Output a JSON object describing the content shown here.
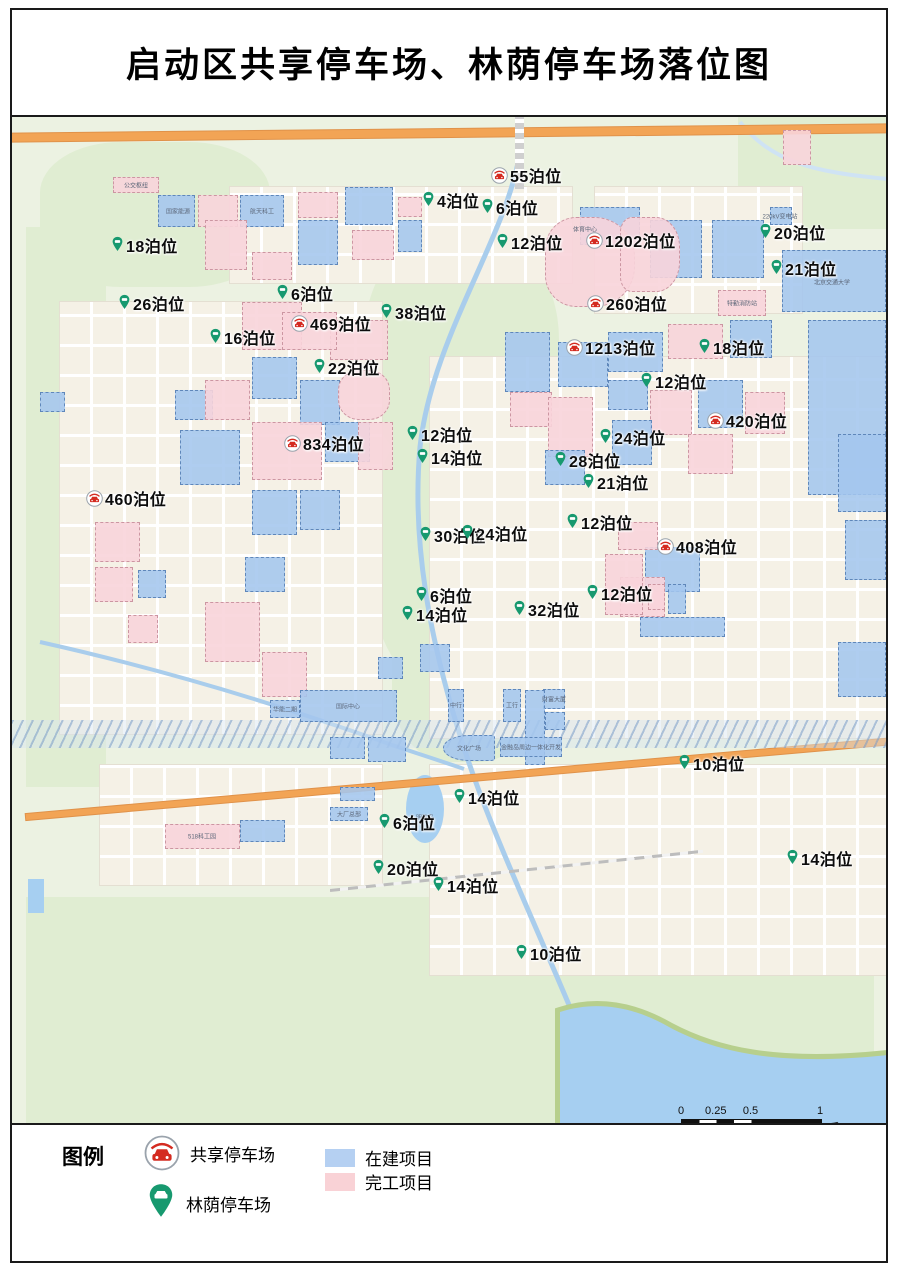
{
  "title": "启动区共享停车场、林荫停车场落位图",
  "legend": {
    "heading": "图例",
    "shared_label": "共享停车场",
    "shade_label": "林荫停车场",
    "construction_label": "在建项目",
    "completed_label": "完工项目",
    "colors": {
      "construction_fill": "#a4c6ee",
      "completed_fill": "#f8d4da",
      "shared_icon_red": "#d42b20",
      "shade_icon_green": "#17996f"
    }
  },
  "scalebar": {
    "ticks": [
      "0",
      "0.25",
      "0.5",
      "1"
    ],
    "unit": "千米"
  },
  "map": {
    "markers": [
      {
        "type": "shared",
        "label": "55泊位",
        "x": 485,
        "y": 60
      },
      {
        "type": "shared",
        "label": "1202泊位",
        "x": 580,
        "y": 125
      },
      {
        "type": "shared",
        "label": "469泊位",
        "x": 285,
        "y": 208
      },
      {
        "type": "shared",
        "label": "260泊位",
        "x": 581,
        "y": 188
      },
      {
        "type": "shared",
        "label": "1213泊位",
        "x": 560,
        "y": 232
      },
      {
        "type": "shared",
        "label": "834泊位",
        "x": 278,
        "y": 328
      },
      {
        "type": "shared",
        "label": "460泊位",
        "x": 80,
        "y": 383
      },
      {
        "type": "shared",
        "label": "420泊位",
        "x": 701,
        "y": 305
      },
      {
        "type": "shared",
        "label": "408泊位",
        "x": 651,
        "y": 431
      },
      {
        "type": "shade",
        "label": "4泊位",
        "x": 416,
        "y": 85
      },
      {
        "type": "shade",
        "label": "6泊位",
        "x": 475,
        "y": 92
      },
      {
        "type": "shade",
        "label": "12泊位",
        "x": 490,
        "y": 127
      },
      {
        "type": "shade",
        "label": "18泊位",
        "x": 105,
        "y": 130
      },
      {
        "type": "shade",
        "label": "20泊位",
        "x": 753,
        "y": 117
      },
      {
        "type": "shade",
        "label": "21泊位",
        "x": 764,
        "y": 153
      },
      {
        "type": "shade",
        "label": "26泊位",
        "x": 112,
        "y": 188
      },
      {
        "type": "shade",
        "label": "6泊位",
        "x": 270,
        "y": 178
      },
      {
        "type": "shade",
        "label": "16泊位",
        "x": 203,
        "y": 222
      },
      {
        "type": "shade",
        "label": "38泊位",
        "x": 374,
        "y": 197
      },
      {
        "type": "shade",
        "label": "22泊位",
        "x": 307,
        "y": 252
      },
      {
        "type": "shade",
        "label": "18泊位",
        "x": 692,
        "y": 232
      },
      {
        "type": "shade",
        "label": "12泊位",
        "x": 634,
        "y": 266
      },
      {
        "type": "shade",
        "label": "12泊位",
        "x": 400,
        "y": 319
      },
      {
        "type": "shade",
        "label": "14泊位",
        "x": 410,
        "y": 342
      },
      {
        "type": "shade",
        "label": "24泊位",
        "x": 593,
        "y": 322
      },
      {
        "type": "shade",
        "label": "28泊位",
        "x": 548,
        "y": 345
      },
      {
        "type": "shade",
        "label": "21泊位",
        "x": 576,
        "y": 367
      },
      {
        "type": "shade",
        "label": "12泊位",
        "x": 560,
        "y": 407
      },
      {
        "type": "shade",
        "label": "30泊位",
        "x": 413,
        "y": 420
      },
      {
        "type": "shade",
        "label": "24泊位",
        "x": 455,
        "y": 418
      },
      {
        "type": "shade",
        "label": "6泊位",
        "x": 409,
        "y": 480
      },
      {
        "type": "shade",
        "label": "14泊位",
        "x": 395,
        "y": 499
      },
      {
        "type": "shade",
        "label": "32泊位",
        "x": 507,
        "y": 494
      },
      {
        "type": "shade",
        "label": "12泊位",
        "x": 580,
        "y": 478
      },
      {
        "type": "shade",
        "label": "10泊位",
        "x": 672,
        "y": 648
      },
      {
        "type": "shade",
        "label": "14泊位",
        "x": 447,
        "y": 682
      },
      {
        "type": "shade",
        "label": "6泊位",
        "x": 372,
        "y": 707
      },
      {
        "type": "shade",
        "label": "20泊位",
        "x": 366,
        "y": 753
      },
      {
        "type": "shade",
        "label": "14泊位",
        "x": 426,
        "y": 770
      },
      {
        "type": "shade",
        "label": "10泊位",
        "x": 509,
        "y": 838
      },
      {
        "type": "shade",
        "label": "14泊位",
        "x": 780,
        "y": 743
      }
    ],
    "labels": [
      {
        "t": "体育中心",
        "x": 573,
        "y": 112
      },
      {
        "t": "北京交通大学",
        "x": 820,
        "y": 165
      },
      {
        "t": "220kV变电站",
        "x": 768,
        "y": 99
      },
      {
        "t": "特勤消防站",
        "x": 730,
        "y": 186
      },
      {
        "t": "公交枢纽",
        "x": 124,
        "y": 68
      },
      {
        "t": "国家能源",
        "x": 166,
        "y": 94
      },
      {
        "t": "航天科工",
        "x": 250,
        "y": 94
      },
      {
        "t": "文化广场",
        "x": 457,
        "y": 631
      },
      {
        "t": "金融岛周边一体化开发",
        "x": 519,
        "y": 630
      },
      {
        "t": "明珠岛",
        "x": 413,
        "y": 700
      },
      {
        "t": "大厂总部",
        "x": 337,
        "y": 697
      },
      {
        "t": "518科工园",
        "x": 190,
        "y": 719
      },
      {
        "t": "国际中心",
        "x": 336,
        "y": 589
      },
      {
        "t": "华能二期",
        "x": 273,
        "y": 592
      },
      {
        "t": "财富大厦",
        "x": 542,
        "y": 582
      },
      {
        "t": "中行",
        "x": 444,
        "y": 588
      },
      {
        "t": "工行",
        "x": 500,
        "y": 588
      }
    ],
    "shapes": [
      {
        "t": "b",
        "x": 146,
        "y": 78,
        "w": 37,
        "h": 32
      },
      {
        "t": "p",
        "x": 186,
        "y": 78,
        "w": 40,
        "h": 32
      },
      {
        "t": "b",
        "x": 228,
        "y": 78,
        "w": 44,
        "h": 32
      },
      {
        "t": "p",
        "x": 101,
        "y": 60,
        "w": 46,
        "h": 16
      },
      {
        "t": "p",
        "x": 193,
        "y": 103,
        "w": 42,
        "h": 50
      },
      {
        "t": "p",
        "x": 240,
        "y": 135,
        "w": 40,
        "h": 28
      },
      {
        "t": "b",
        "x": 286,
        "y": 103,
        "w": 40,
        "h": 45
      },
      {
        "t": "p",
        "x": 286,
        "y": 75,
        "w": 40,
        "h": 26
      },
      {
        "t": "b",
        "x": 333,
        "y": 70,
        "w": 48,
        "h": 38
      },
      {
        "t": "p",
        "x": 340,
        "y": 113,
        "w": 42,
        "h": 30
      },
      {
        "t": "b",
        "x": 386,
        "y": 103,
        "w": 24,
        "h": 32
      },
      {
        "t": "p",
        "x": 386,
        "y": 80,
        "w": 24,
        "h": 20
      },
      {
        "t": "b",
        "x": 568,
        "y": 90,
        "w": 60,
        "h": 38
      },
      {
        "t": "b",
        "x": 638,
        "y": 103,
        "w": 52,
        "h": 58
      },
      {
        "t": "b",
        "x": 700,
        "y": 103,
        "w": 52,
        "h": 58
      },
      {
        "t": "p",
        "x": 533,
        "y": 100,
        "w": 90,
        "h": 90,
        "br": "35% 45% 45% 35%"
      },
      {
        "t": "p",
        "x": 608,
        "y": 100,
        "w": 60,
        "h": 75,
        "br": "20% 40% 40% 20%"
      },
      {
        "t": "b",
        "x": 770,
        "y": 133,
        "w": 104,
        "h": 62
      },
      {
        "t": "b",
        "x": 758,
        "y": 90,
        "w": 22,
        "h": 18
      },
      {
        "t": "p",
        "x": 771,
        "y": 13,
        "w": 28,
        "h": 35
      },
      {
        "t": "b",
        "x": 796,
        "y": 203,
        "w": 78,
        "h": 175
      },
      {
        "t": "p",
        "x": 706,
        "y": 173,
        "w": 48,
        "h": 26
      },
      {
        "t": "p",
        "x": 230,
        "y": 185,
        "w": 60,
        "h": 48
      },
      {
        "t": "b",
        "x": 163,
        "y": 273,
        "w": 38,
        "h": 30
      },
      {
        "t": "p",
        "x": 193,
        "y": 263,
        "w": 45,
        "h": 40
      },
      {
        "t": "b",
        "x": 240,
        "y": 240,
        "w": 45,
        "h": 42
      },
      {
        "t": "b",
        "x": 288,
        "y": 263,
        "w": 40,
        "h": 45
      },
      {
        "t": "p",
        "x": 318,
        "y": 203,
        "w": 58,
        "h": 40
      },
      {
        "t": "p",
        "x": 270,
        "y": 195,
        "w": 55,
        "h": 38
      },
      {
        "t": "p",
        "x": 326,
        "y": 253,
        "w": 52,
        "h": 50,
        "br": "40%"
      },
      {
        "t": "b",
        "x": 168,
        "y": 313,
        "w": 60,
        "h": 55
      },
      {
        "t": "p",
        "x": 240,
        "y": 305,
        "w": 70,
        "h": 58
      },
      {
        "t": "b",
        "x": 313,
        "y": 305,
        "w": 45,
        "h": 40
      },
      {
        "t": "p",
        "x": 346,
        "y": 305,
        "w": 35,
        "h": 48
      },
      {
        "t": "b",
        "x": 240,
        "y": 373,
        "w": 45,
        "h": 45
      },
      {
        "t": "b",
        "x": 288,
        "y": 373,
        "w": 40,
        "h": 40
      },
      {
        "t": "p",
        "x": 193,
        "y": 485,
        "w": 55,
        "h": 60
      },
      {
        "t": "p",
        "x": 250,
        "y": 535,
        "w": 45,
        "h": 45
      },
      {
        "t": "b",
        "x": 233,
        "y": 440,
        "w": 40,
        "h": 35
      },
      {
        "t": "b",
        "x": 126,
        "y": 453,
        "w": 28,
        "h": 28
      },
      {
        "t": "p",
        "x": 116,
        "y": 498,
        "w": 30,
        "h": 28
      },
      {
        "t": "p",
        "x": 83,
        "y": 405,
        "w": 45,
        "h": 40
      },
      {
        "t": "p",
        "x": 83,
        "y": 450,
        "w": 38,
        "h": 35
      },
      {
        "t": "b",
        "x": 28,
        "y": 275,
        "w": 25,
        "h": 20
      },
      {
        "t": "b",
        "x": 493,
        "y": 215,
        "w": 45,
        "h": 60
      },
      {
        "t": "b",
        "x": 546,
        "y": 225,
        "w": 50,
        "h": 45
      },
      {
        "t": "p",
        "x": 498,
        "y": 275,
        "w": 42,
        "h": 35
      },
      {
        "t": "p",
        "x": 536,
        "y": 280,
        "w": 45,
        "h": 60
      },
      {
        "t": "b",
        "x": 596,
        "y": 215,
        "w": 55,
        "h": 40
      },
      {
        "t": "p",
        "x": 656,
        "y": 207,
        "w": 55,
        "h": 35
      },
      {
        "t": "b",
        "x": 718,
        "y": 203,
        "w": 42,
        "h": 38
      },
      {
        "t": "b",
        "x": 596,
        "y": 263,
        "w": 40,
        "h": 30
      },
      {
        "t": "p",
        "x": 638,
        "y": 273,
        "w": 42,
        "h": 45
      },
      {
        "t": "b",
        "x": 686,
        "y": 263,
        "w": 45,
        "h": 48
      },
      {
        "t": "p",
        "x": 733,
        "y": 275,
        "w": 40,
        "h": 42
      },
      {
        "t": "b",
        "x": 600,
        "y": 303,
        "w": 40,
        "h": 45
      },
      {
        "t": "p",
        "x": 676,
        "y": 317,
        "w": 45,
        "h": 40
      },
      {
        "t": "b",
        "x": 533,
        "y": 333,
        "w": 40,
        "h": 35
      },
      {
        "t": "b",
        "x": 633,
        "y": 430,
        "w": 55,
        "h": 45
      },
      {
        "t": "p",
        "x": 608,
        "y": 460,
        "w": 45,
        "h": 40
      },
      {
        "t": "p",
        "x": 593,
        "y": 437,
        "w": 38,
        "h": 61
      },
      {
        "t": "p",
        "x": 606,
        "y": 405,
        "w": 40,
        "h": 28
      },
      {
        "t": "p",
        "x": 636,
        "y": 467,
        "w": 17,
        "h": 26
      },
      {
        "t": "b",
        "x": 656,
        "y": 467,
        "w": 18,
        "h": 30
      },
      {
        "t": "b",
        "x": 826,
        "y": 317,
        "w": 48,
        "h": 78
      },
      {
        "t": "b",
        "x": 833,
        "y": 403,
        "w": 41,
        "h": 60
      },
      {
        "t": "b",
        "x": 826,
        "y": 525,
        "w": 48,
        "h": 55
      },
      {
        "t": "b",
        "x": 628,
        "y": 500,
        "w": 85,
        "h": 20
      },
      {
        "t": "b",
        "x": 366,
        "y": 540,
        "w": 25,
        "h": 22
      },
      {
        "t": "b",
        "x": 408,
        "y": 527,
        "w": 30,
        "h": 28
      },
      {
        "t": "b",
        "x": 436,
        "y": 572,
        "w": 16,
        "h": 33
      },
      {
        "t": "b",
        "x": 491,
        "y": 572,
        "w": 18,
        "h": 33
      },
      {
        "t": "b",
        "x": 531,
        "y": 572,
        "w": 22,
        "h": 20
      },
      {
        "t": "b",
        "x": 533,
        "y": 595,
        "w": 20,
        "h": 18
      },
      {
        "t": "b",
        "x": 513,
        "y": 573,
        "w": 20,
        "h": 75
      },
      {
        "t": "b",
        "x": 431,
        "y": 618,
        "w": 52,
        "h": 26,
        "br": "60% 10% 10% 60%"
      },
      {
        "t": "b",
        "x": 488,
        "y": 620,
        "w": 62,
        "h": 20
      },
      {
        "t": "b",
        "x": 258,
        "y": 583,
        "w": 30,
        "h": 18
      },
      {
        "t": "b",
        "x": 288,
        "y": 573,
        "w": 97,
        "h": 32
      },
      {
        "t": "b",
        "x": 318,
        "y": 620,
        "w": 35,
        "h": 22
      },
      {
        "t": "b",
        "x": 356,
        "y": 620,
        "w": 38,
        "h": 25
      },
      {
        "t": "b",
        "x": 328,
        "y": 670,
        "w": 35,
        "h": 14
      },
      {
        "t": "b",
        "x": 318,
        "y": 690,
        "w": 38,
        "h": 14
      },
      {
        "t": "p",
        "x": 153,
        "y": 707,
        "w": 75,
        "h": 25
      },
      {
        "t": "b",
        "x": 228,
        "y": 703,
        "w": 45,
        "h": 22
      }
    ]
  }
}
